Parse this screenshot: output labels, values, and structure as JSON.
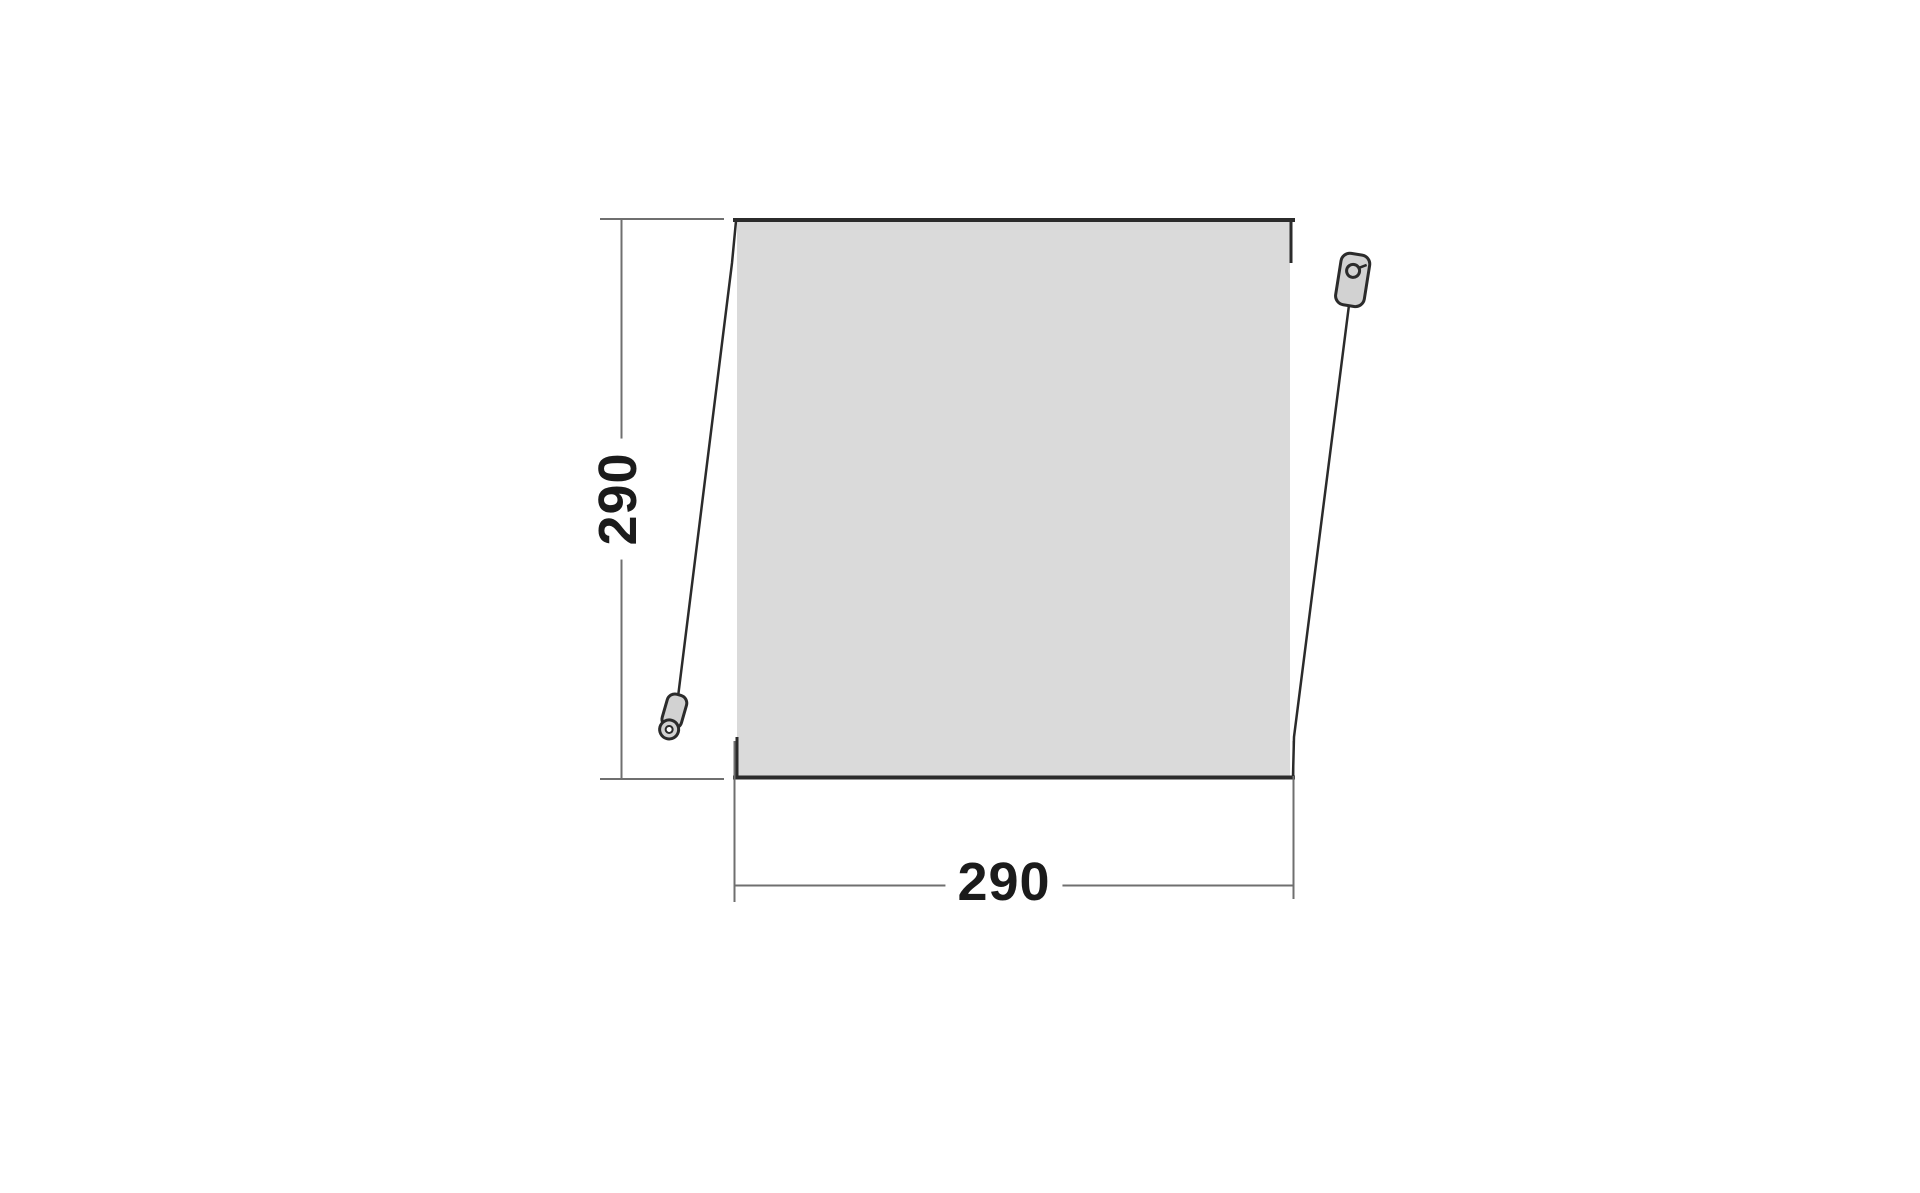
{
  "diagram": {
    "dimensions": {
      "height": "290",
      "width": "290"
    },
    "icons": [
      "peg-left-icon",
      "peg-right-icon"
    ],
    "colors": {
      "background": "#ffffff",
      "panel_fill": "#dadada",
      "outline": "#2b2b2b",
      "dimension_line": "#6f6f6f",
      "label_text": "#1b1b1b",
      "peg_fill": "#d2d2d2"
    }
  }
}
